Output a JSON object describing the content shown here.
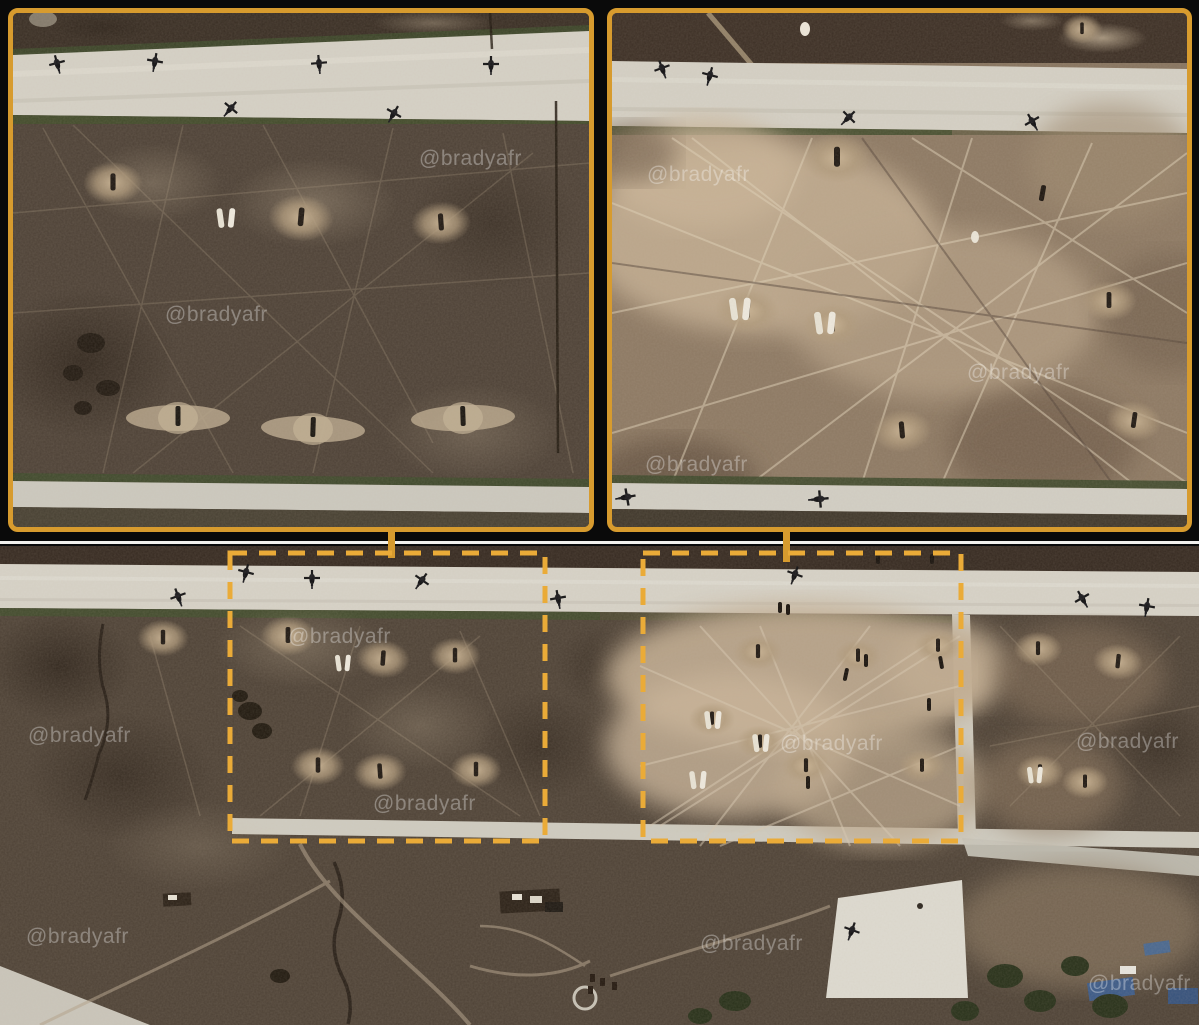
{
  "watermark": {
    "text": "@bradyafr"
  },
  "colors": {
    "background": "#0a0a0a",
    "frame_orange": "#d79b2e",
    "roi_dash_orange": "#eaab38",
    "divider_white": "#f2f1ed",
    "runway_light": "#d7d3c8",
    "terrain_brown": "#4e4236",
    "blast_tan": "#c2ad92"
  }
}
